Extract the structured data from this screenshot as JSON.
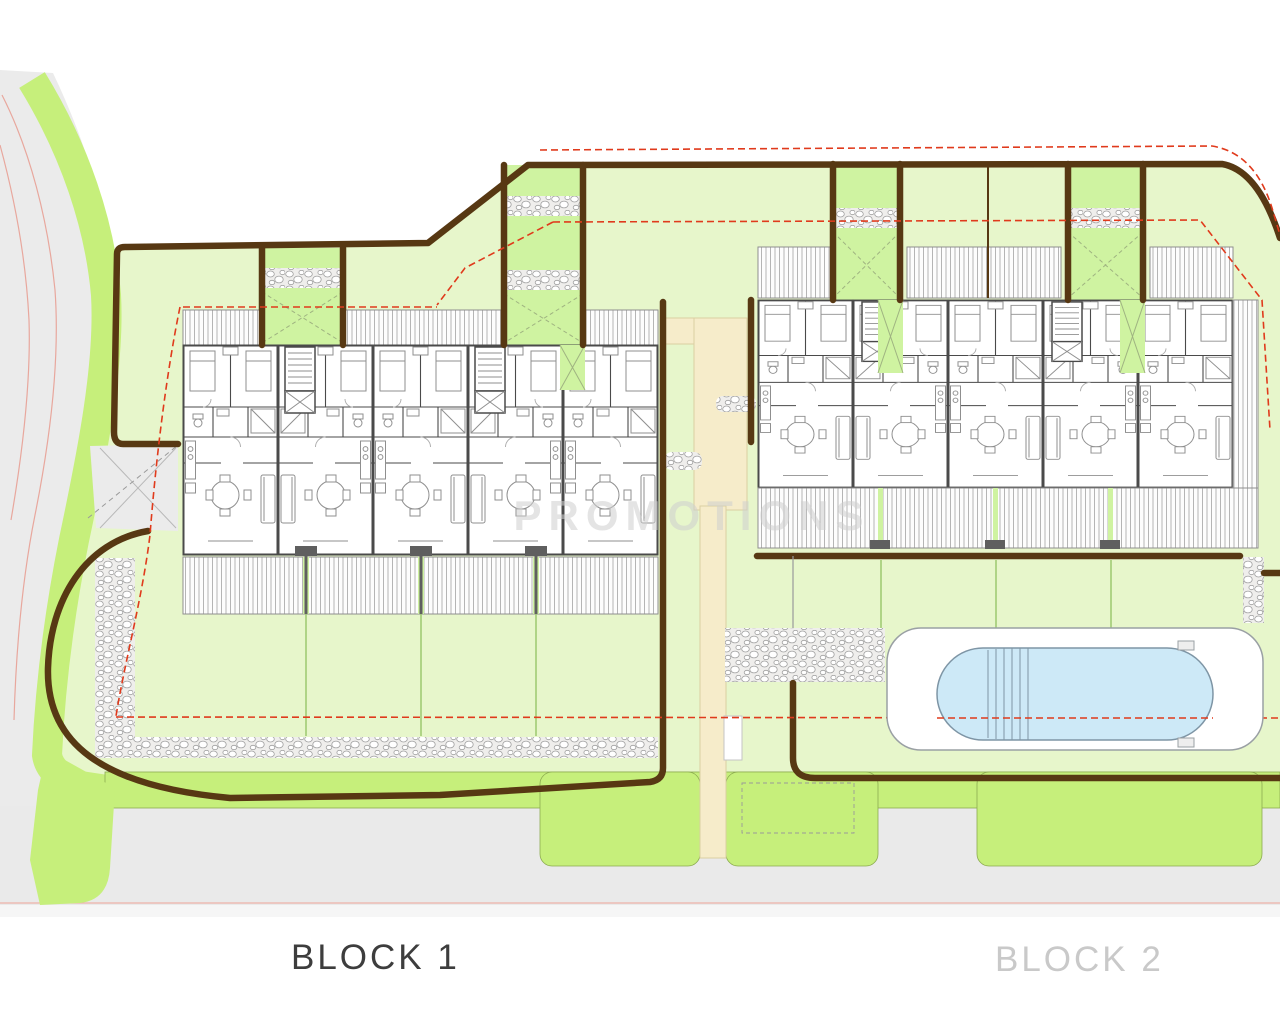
{
  "labels": {
    "block1": "BLOCK 1",
    "block2": "BLOCK 2"
  },
  "watermark": {
    "text": "PROMOTIONS"
  },
  "colors": {
    "road": "#ebebeb",
    "roadLine": "#e8a79d",
    "verge": "#c6ef7b",
    "vergeEdge": "#8cab50",
    "lawn": "#e7f6cb",
    "garden": "#cff3a1",
    "wall": "#573813",
    "red": "#e03a1c",
    "beige": "#f6ecca",
    "beigeEdge": "#dbcfa2",
    "pool": "#cde9f7",
    "poolEdge": "#7e95a5",
    "deckEdge": "#9aa0a4",
    "hatchLine": "#b5b5b5",
    "hatchEdge": "#8f8f8f",
    "planWall": "#4a4a4a",
    "furn": "#8f8f8f",
    "pebbleBg": "#efeeec",
    "stoneEdge": "#a0a0a0",
    "labelDark": "#3d3d3d",
    "labelLight": "#c9c9c9",
    "watermark": "#cfcfcf",
    "grayDash": "#9a9a9a",
    "xmark": "#9fb381",
    "spine": "#5f5f5f",
    "greenLine": "#9cc86e",
    "bottomRoad": "#eaeaea",
    "hairline": "#eeb2a9",
    "gate": "#c4c4c4",
    "driveX": "#b8b8b8"
  }
}
